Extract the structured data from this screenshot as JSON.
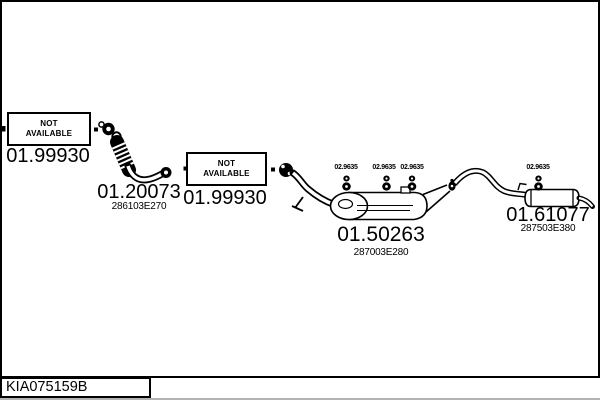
{
  "diagram": {
    "background": "#ffffff",
    "line_color": "#000000",
    "drawing_number": "KIA075159B",
    "not_available_label": "NOT AVAILABLE",
    "sections": {
      "front_pipe": {
        "code": "01.99930"
      },
      "flex_pipe": {
        "code": "01.20073",
        "part_number": "286103E270"
      },
      "center_pipe": {
        "code": "01.99930"
      },
      "center_muffler": {
        "code": "01.50263",
        "part_number": "287003E280"
      },
      "rear_muffler": {
        "code": "01.61077",
        "part_number": "287503E380"
      },
      "hanger": {
        "code": "02.9635"
      }
    }
  }
}
